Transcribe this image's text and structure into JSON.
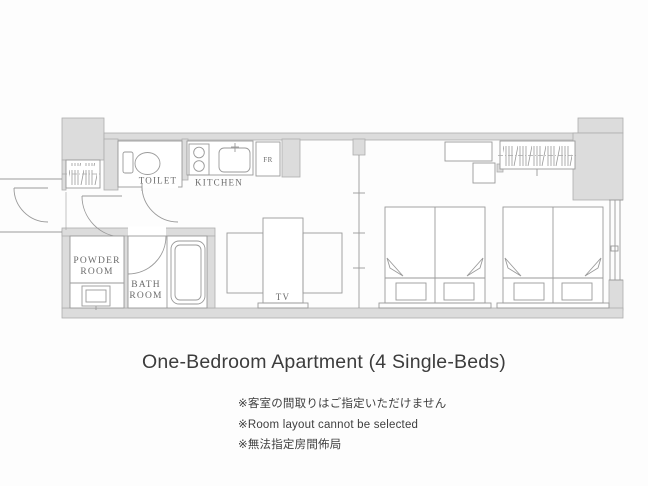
{
  "title": "One-Bedroom Apartment (4 Single-Beds)",
  "notes": {
    "jp": "※客室の間取りはご指定いただけません",
    "en": "※Room layout cannot be selected",
    "zh": "※無法指定房間佈局"
  },
  "floorplan": {
    "labels": {
      "toilet": "TOILET",
      "kitchen": "KITCHEN",
      "fridge": "FR",
      "powder1": "POWDER",
      "powder2": "ROOM",
      "bath1": "BATH",
      "bath2": "ROOM",
      "tv": "TV"
    },
    "colors": {
      "wall_fill": "#dcdcdc",
      "line": "#9a9a9a",
      "label_text": "#6b6b6b",
      "title_text": "#3c3c3c"
    }
  }
}
